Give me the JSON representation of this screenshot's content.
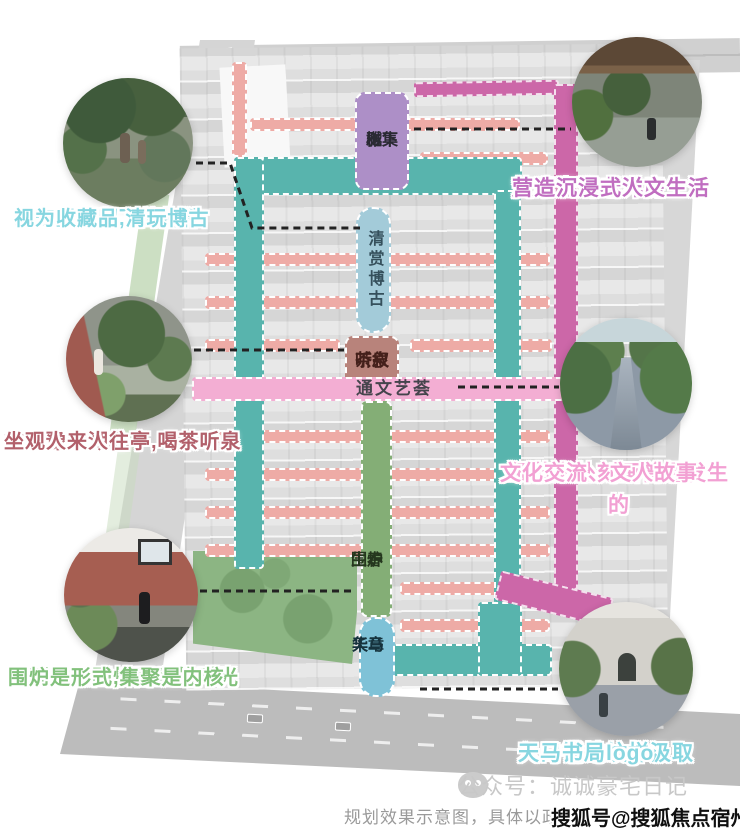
{
  "colors": {
    "teal": "#58b4ad",
    "magenta": "#cc67a8",
    "salmon": "#eeaba6",
    "parkGreen": "#8cb583"
  },
  "zones": {
    "yuexia": {
      "line1": "樾下",
      "line2": "雅集",
      "bg": "#ad8fc7",
      "color": "#2a2a33"
    },
    "qingshang": {
      "label": "清赏博古",
      "bg": "#a3cbd9",
      "color": "#35505c"
    },
    "tingquan": {
      "line1": "听泉",
      "line2": "茶叙",
      "bg": "#b8837b",
      "color": "#44201b"
    },
    "tongwen": {
      "label": "通文艺荟",
      "bg": "#f3aed3",
      "color": "#45444c"
    },
    "weilu": {
      "line1": "围炉",
      "line2": "生春",
      "bg": "#84ae76",
      "color": "#25371e"
    },
    "tianma": {
      "line1": "天马",
      "line2": "华章",
      "bg": "#7fc2d7",
      "color": "#16333d"
    }
  },
  "annotations": {
    "heritage": {
      "line1": "弘安里保留下的构件",
      "line2": "视为收藏品,清玩博古",
      "color": "#87d6e0"
    },
    "restore": {
      "line1": "复原上海老洋房生活",
      "line2": "营造沉浸式人文生活",
      "color": "#c06ec0"
    },
    "teahouse": {
      "line1": "重回豫园湖心亭,喝茶听泉",
      "line2": "坐观人来人往",
      "color": "#b2606b"
    },
    "detail": {
      "line1": "细节之处刻画曾经发生的",
      "line2": "文化交流、文人故事",
      "color": "#f2a0d3"
    },
    "stove": {
      "line1": "回到过去围炉而坐的时光",
      "line2": "围炉是形式,集聚是内核",
      "color": "#82c17c"
    },
    "entrance": {
      "line1": "入口铺地纹样汲取",
      "line2": "天马书局logo",
      "color": "#87d6e0"
    }
  },
  "footer": {
    "disclaimer": "规划效果示意图，具体以政府",
    "wechat_watermark": "公众号：诚诚豪宅日记",
    "sohu_watermark": "搜狐号@搜狐焦点宿州站"
  }
}
